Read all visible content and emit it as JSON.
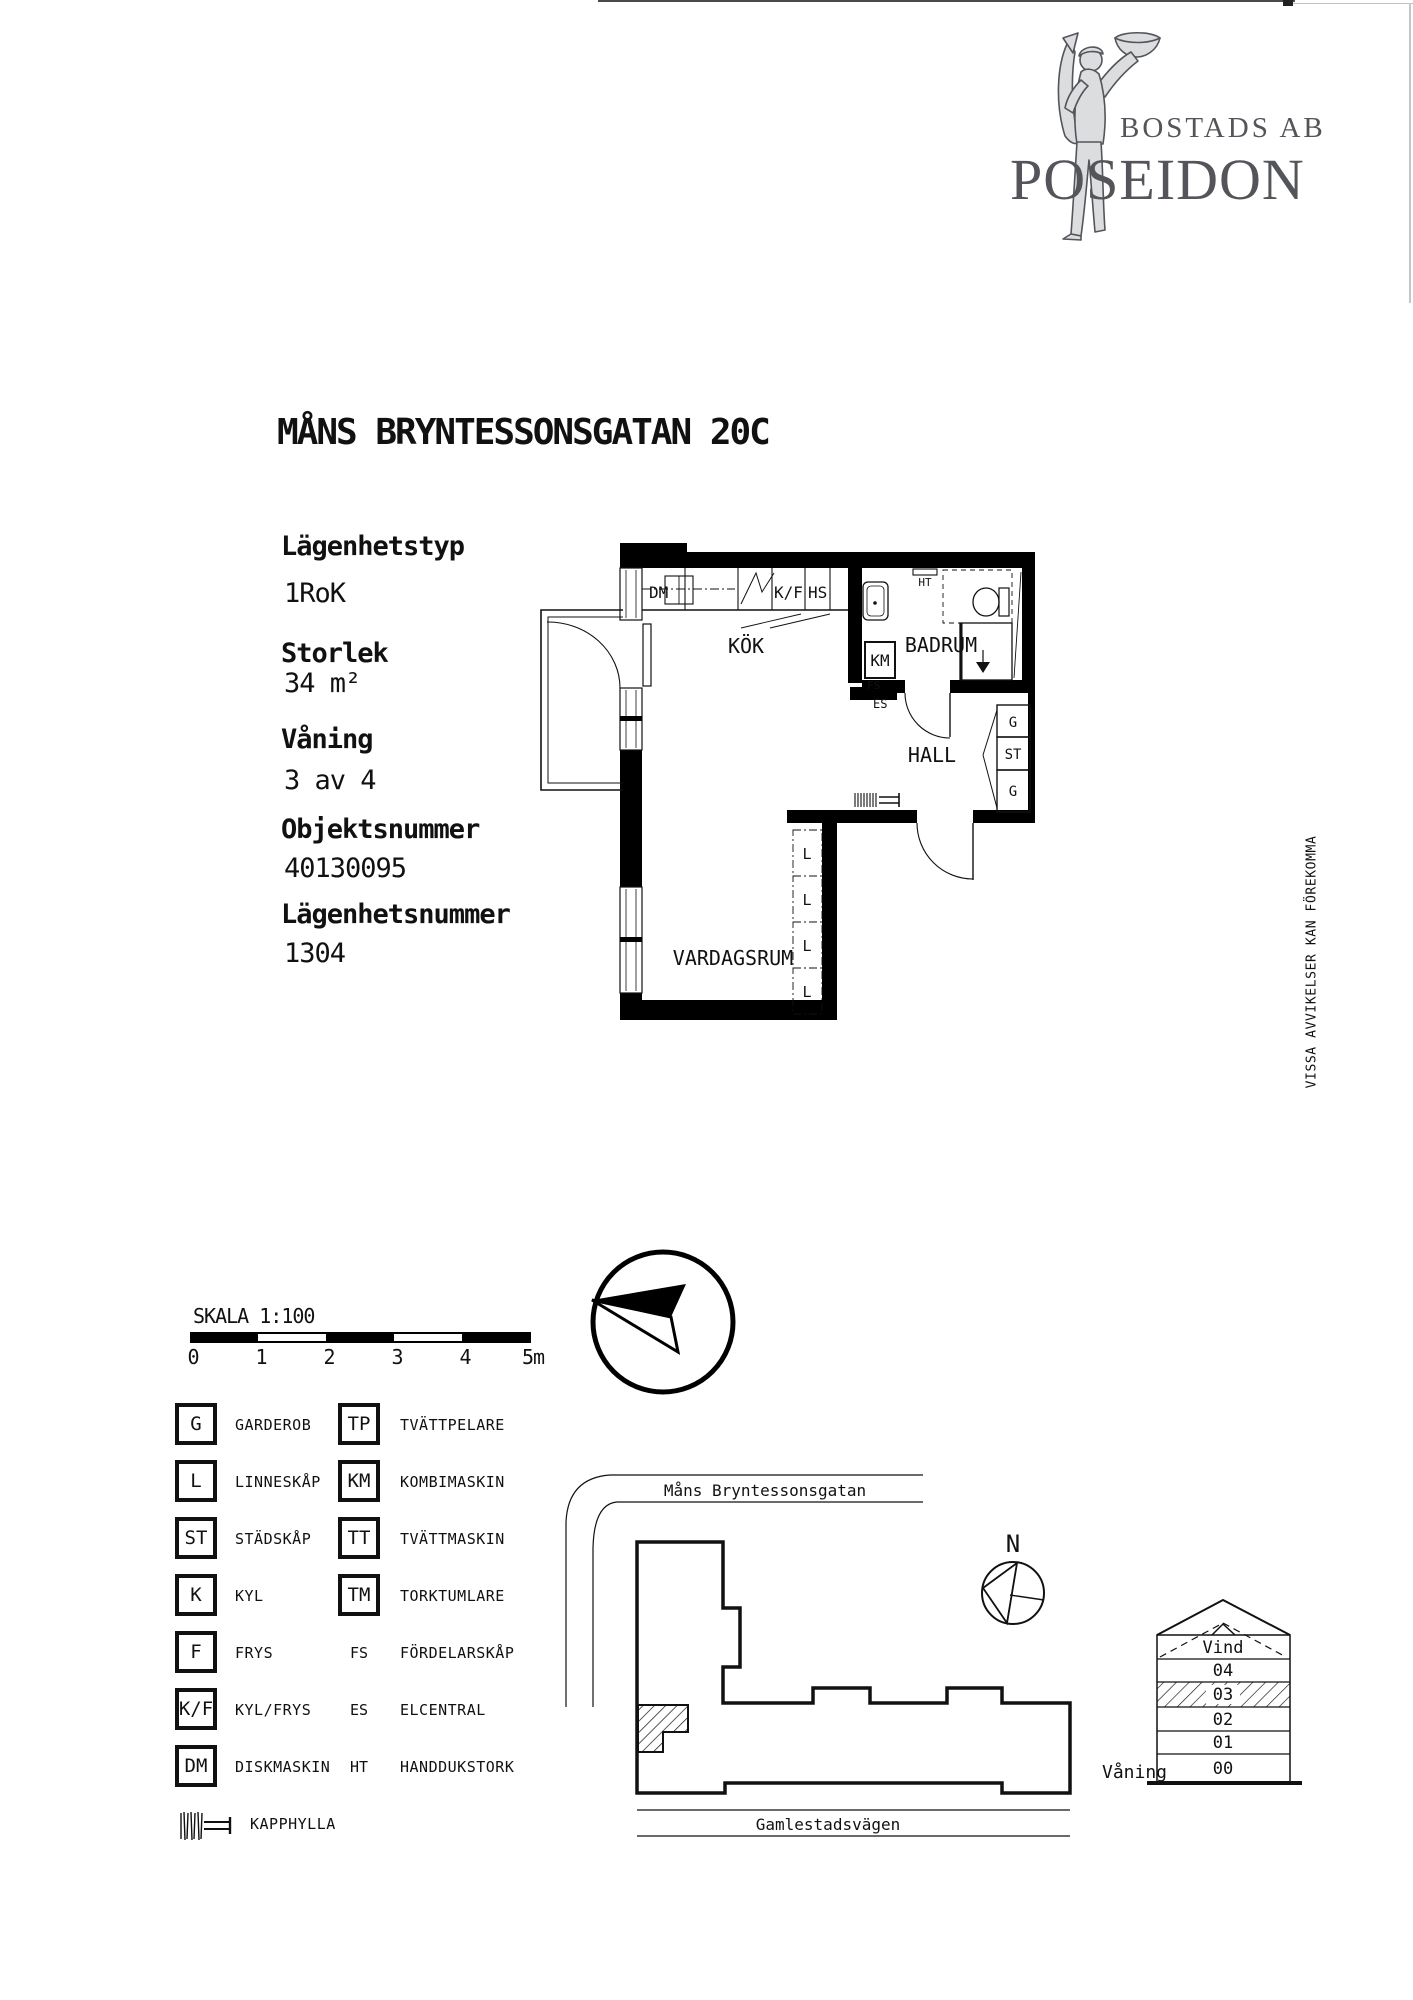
{
  "page": {
    "notice": "VISSA AVVIKELSER KAN FÖREKOMMA"
  },
  "logo": {
    "line1": "BOSTADS AB",
    "line2": "POSEIDON"
  },
  "title": "MÅNS BRYNTESSONSGATAN 20C",
  "info": [
    {
      "label": "Lägenhetstyp",
      "value": "1RoK"
    },
    {
      "label": "Storlek",
      "value": "34 m²"
    },
    {
      "label": "Våning",
      "value": "3 av 4"
    },
    {
      "label": "Objektsnummer",
      "value": "40130095"
    },
    {
      "label": "Lägenhetsnummer",
      "value": "1304"
    }
  ],
  "plan": {
    "rooms": {
      "kitchen": "KÖK",
      "bathroom": "BADRUM",
      "hall": "HALL",
      "living_room": "VARDAGSRUM"
    },
    "fixtures": {
      "dm": "DM",
      "kf": "K/F",
      "hs": "HS",
      "ht": "HT",
      "km": "KM",
      "fs": "FS",
      "es": "ES",
      "closet_g": "G",
      "closet_st": "ST",
      "wardrobe_l": "L"
    }
  },
  "scale_bar": {
    "label": "SKALA 1:100",
    "ticks": [
      "0",
      "1",
      "2",
      "3",
      "4",
      "5m"
    ]
  },
  "legend": {
    "left": [
      {
        "symbol": "G",
        "label": "GARDEROB",
        "boxed": true
      },
      {
        "symbol": "L",
        "label": "LINNESKÅP",
        "boxed": true
      },
      {
        "symbol": "ST",
        "label": "STÄDSKÅP",
        "boxed": true
      },
      {
        "symbol": "K",
        "label": "KYL",
        "boxed": true
      },
      {
        "symbol": "F",
        "label": "FRYS",
        "boxed": true
      },
      {
        "symbol": "K/F",
        "label": "KYL/FRYS",
        "boxed": true
      },
      {
        "symbol": "DM",
        "label": "DISKMASKIN",
        "boxed": true
      }
    ],
    "right": [
      {
        "symbol": "TP",
        "label": "TVÄTTPELARE",
        "boxed": true
      },
      {
        "symbol": "KM",
        "label": "KOMBIMASKIN",
        "boxed": true
      },
      {
        "symbol": "TT",
        "label": "TVÄTTMASKIN",
        "boxed": true
      },
      {
        "symbol": "TM",
        "label": "TORKTUMLARE",
        "boxed": true
      },
      {
        "symbol": "FS",
        "label": "FÖRDELARSKÅP",
        "boxed": false
      },
      {
        "symbol": "ES",
        "label": "ELCENTRAL",
        "boxed": false
      },
      {
        "symbol": "HT",
        "label": "HANDDUKSTORK",
        "boxed": false
      }
    ],
    "kapphylla_label": "KAPPHYLLA"
  },
  "site_plan": {
    "street_top": "Måns Bryntessonsgatan",
    "street_bottom": "Gamlestadsvägen",
    "north_label": "N"
  },
  "elevation": {
    "floors": [
      "Vind",
      "04",
      "03",
      "02",
      "01",
      "00"
    ],
    "highlighted_floor": "03",
    "axis_label": "Våning"
  }
}
